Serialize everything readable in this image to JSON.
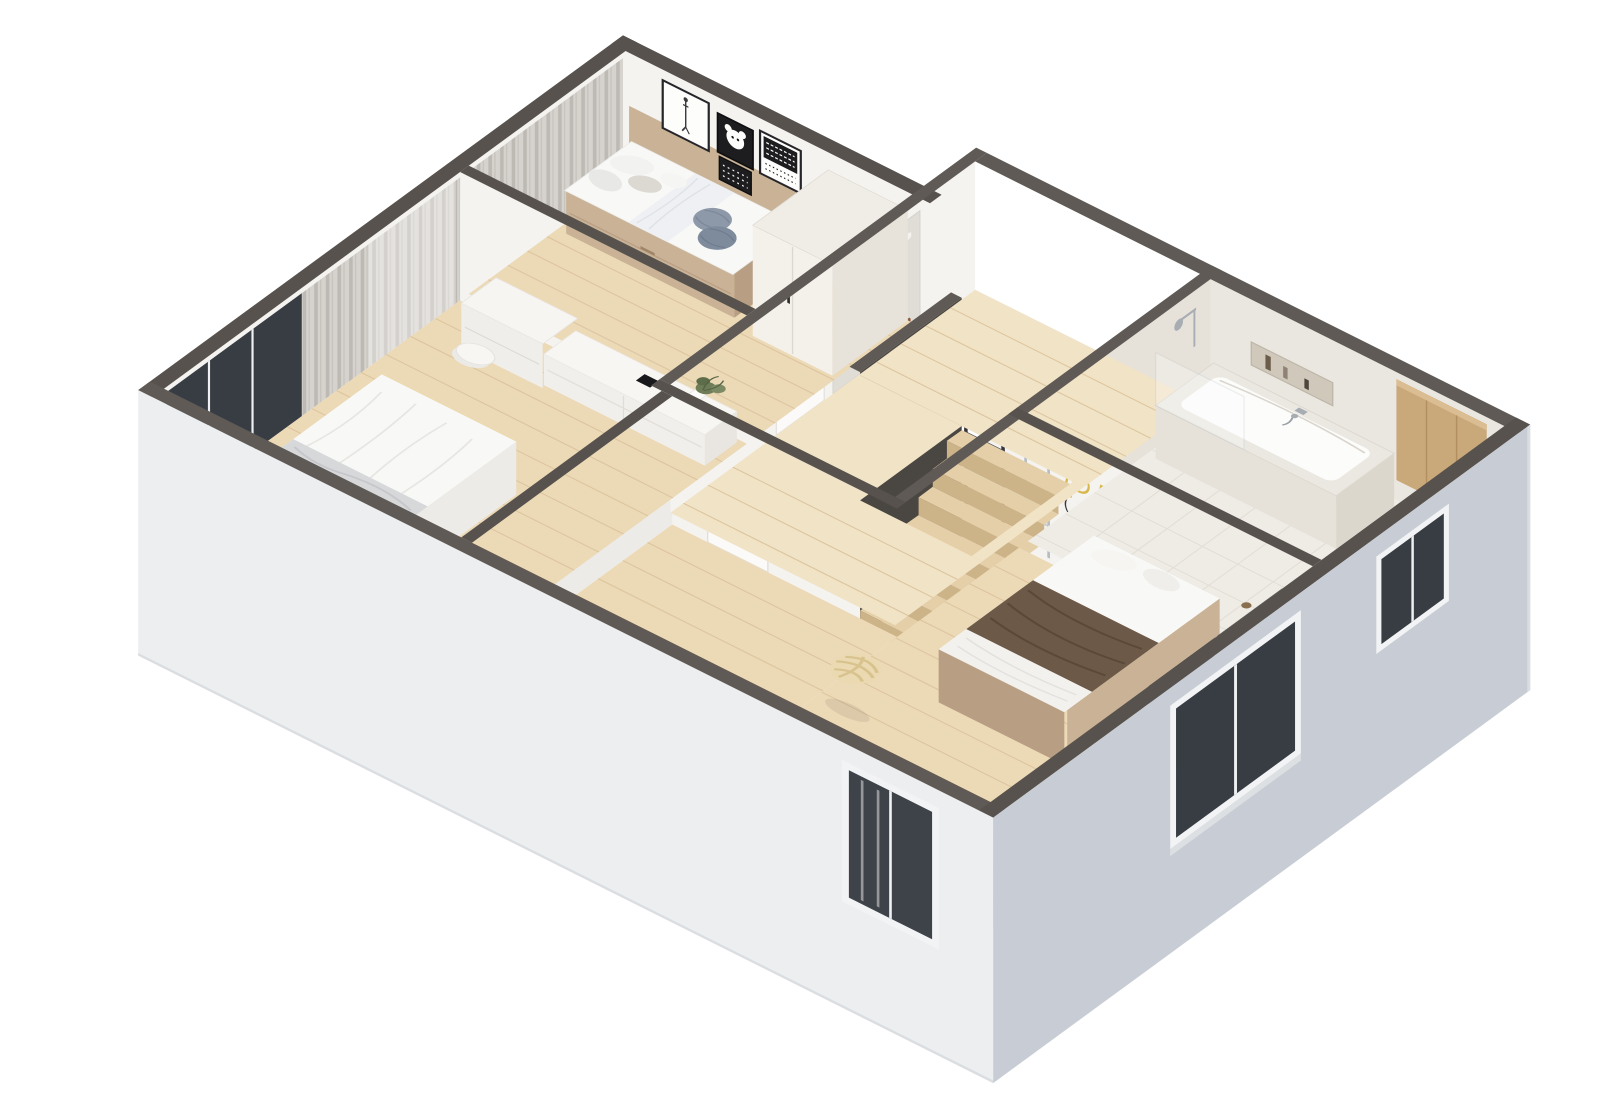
{
  "scene": {
    "title": "isometric-3d-floor-plan-render",
    "play_sign": {
      "text": "PLAY"
    },
    "stairs": {
      "treads": 7
    },
    "rooms": [
      {
        "id": "kids-bedroom",
        "furniture": [
          "single-bed-with-drawer",
          "pillows",
          "round-blue-pillows",
          "wall-art-frames",
          "wardrobe",
          "curtains"
        ]
      },
      {
        "id": "master-bedroom",
        "furniture": [
          "double-bed",
          "gray-marble-blanket",
          "tv",
          "tv-console",
          "dressing-table",
          "round-stool",
          "plant",
          "floor-to-ceiling-window",
          "curtains"
        ]
      },
      {
        "id": "hallway-landing",
        "furniture": [
          "wooden-staircase",
          "climbing-wall",
          "interior-door-kids",
          "interior-door-bedroom"
        ]
      },
      {
        "id": "bathroom",
        "furniture": [
          "bathtub",
          "shower-fixture",
          "glass-screen",
          "wall-niche-with-bottles",
          "wooden-cabinet",
          "toilet",
          "toilet-brush",
          "door"
        ]
      },
      {
        "id": "bedroom-2",
        "furniture": [
          "double-bed",
          "brown-blanket",
          "upholstered-headboard",
          "play-neon-sign",
          "wall-bars",
          "knot-pouf",
          "window-with-curtains"
        ]
      }
    ],
    "art_frames": 3,
    "climbing_holds": 14
  },
  "colors": {
    "bg": "#ffffff",
    "wall_top": "#57524d",
    "wall_top2": "#5f5a55",
    "wall_face": "#f4f3f0",
    "wall_face_shade": "#edebe7",
    "beige_wall": "#e7e2d9",
    "facade_sw": "#eceef0",
    "facade_e": "#c8cdd5",
    "facade_edge": "#dadde1",
    "floor_wood": "#ecd9b6",
    "floor_wood_light": "#f1e3c6",
    "plank": "#dcc49e",
    "tile": "#efece6",
    "tile_line": "#e2ded5",
    "tub_white": "#fcfcfb",
    "stone": "#e6e2d9",
    "stone_dark": "#dcd7cd",
    "wood_cabinet": "#c9a87a",
    "wood_cabinet_line": "#b28f60",
    "tan": "#c9b295",
    "tan_dark": "#b89e82",
    "mattress": "#f8f8f6",
    "duvet": "#f2f1ee",
    "blanket_gray": "#d7d8da",
    "blanket_brown": "#6d5947",
    "blanket_brown_dark": "#5a4839",
    "pillow_blue": "#8d99a9",
    "pillow_blue2": "#7e8b9d",
    "play": "#d8b84a",
    "glass": "#383d44",
    "window_frame": "#f2f3f4",
    "chrome": "#a7adb3",
    "curtain_light": "#d6d3ce",
    "curtain_dark": "#bdb9b3",
    "stair_top": "#e5cfa8",
    "stair_front": "#cdb388",
    "guard": "#4a4642",
    "knot": "#ead9b1",
    "knot_line": "#d8c28e",
    "green": "#6e7d58",
    "green2": "#5d6c49",
    "green3": "#7c8a64",
    "door": "#fbfaf8",
    "door_edge": "#e2dfda",
    "handle": "#2e2c2a",
    "hold_white": "#f5f2ee",
    "hold_red": "#8d5a3b",
    "hold_dark": "#5f4534",
    "hold_tan": "#b98f71",
    "art_dark": "#1d1d20",
    "art_white": "#fdfdfc",
    "climb_board": "#e0ddd7"
  }
}
